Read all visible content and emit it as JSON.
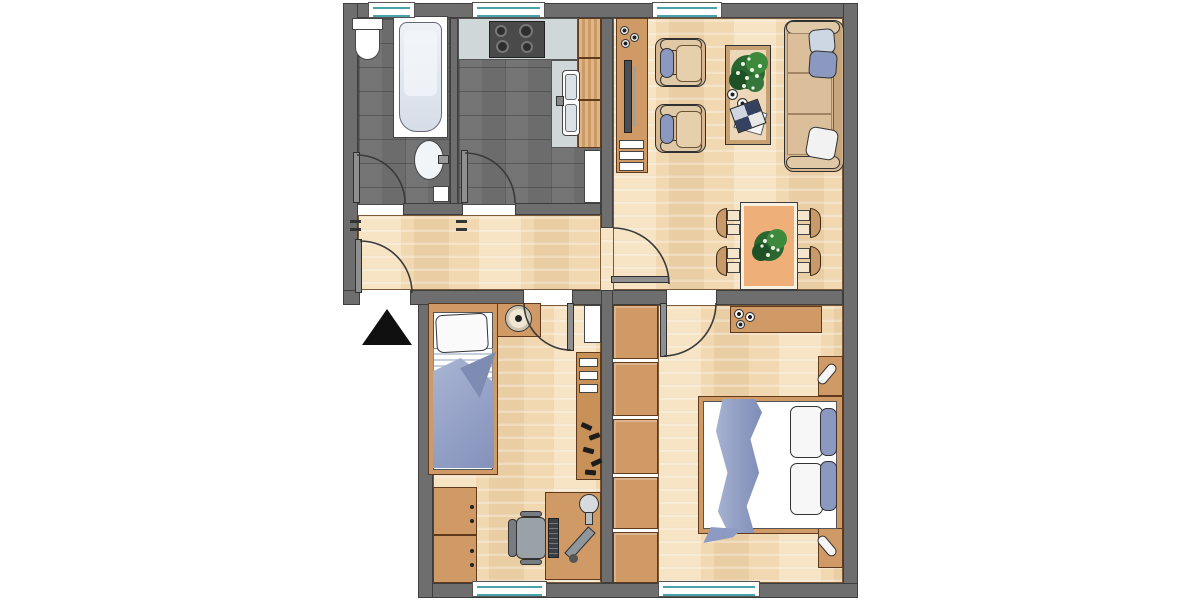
{
  "title": "apartment-floor-plan",
  "colors": {
    "wall": "#6e6e6e",
    "wall_outline": "#3e3e3e",
    "tile_floor": "#6c6c6c",
    "wood_floor": "#f2d8b0",
    "furniture_wood": "#d09a66",
    "furniture_outline": "#5f3a1c",
    "counter_gray": "#cfd7d9",
    "stove_dark": "#4a4a4a",
    "appliance_white": "#ffffff",
    "sofa_tan": "#d6b792",
    "cushion_light": "#e6cfab",
    "pillow_blue": "#8b99c0",
    "pillow_light_blue": "#cdd7e3",
    "blanket_blue": "#94a1c6",
    "window_glass_teal": "#4aa3ab",
    "plant_green": "#2a6630",
    "chair_gray": "#9aa2a8",
    "table_orange": "#efaf78",
    "tub_inner": "#d5dde8",
    "entrance_arrow": "#101010"
  },
  "rooms": [
    {
      "id": "bathroom",
      "floor": "dark-tile",
      "fixtures": [
        "toilet",
        "bathtub",
        "wash-basin",
        "bin"
      ]
    },
    {
      "id": "kitchen",
      "floor": "dark-tile",
      "fixtures": [
        "countertop",
        "stove-4-burners",
        "double-sink",
        "cabinet-column",
        "refrigerator"
      ]
    },
    {
      "id": "living-room",
      "floor": "parquet",
      "fixtures": [
        "tv-sideboard",
        "flat-tv",
        "speaker-decor",
        "armchair",
        "armchair",
        "coffee-table-with-plant",
        "cups",
        "magazines",
        "sofa-with-pillows",
        "dining-table-with-plant",
        "four-dining-chairs"
      ]
    },
    {
      "id": "hallway",
      "floor": "parquet",
      "fixtures": [
        "entrance-door"
      ]
    },
    {
      "id": "bedroom-1",
      "floor": "parquet",
      "fixtures": [
        "single-bed",
        "nightstand-with-clock",
        "white-cabinet",
        "wall-shelf",
        "coat-hooks",
        "chest-of-drawers",
        "desk",
        "office-chair",
        "keyboard",
        "desk-lamp",
        "monitor"
      ]
    },
    {
      "id": "bedroom-2",
      "floor": "parquet",
      "fixtures": [
        "double-bed",
        "blue-throw",
        "four-pillows",
        "nightstand-with-lamp",
        "nightstand-with-lamp",
        "sideboard-with-bowls",
        "built-in-closet-5-doors"
      ]
    }
  ],
  "doors": [
    "entrance",
    "bathroom",
    "kitchen",
    "living-room",
    "bedroom-1",
    "bedroom-2"
  ],
  "windows": {
    "top_wall": 3,
    "bottom_wall": 2
  },
  "entrance_marker": "black-triangle-arrow"
}
